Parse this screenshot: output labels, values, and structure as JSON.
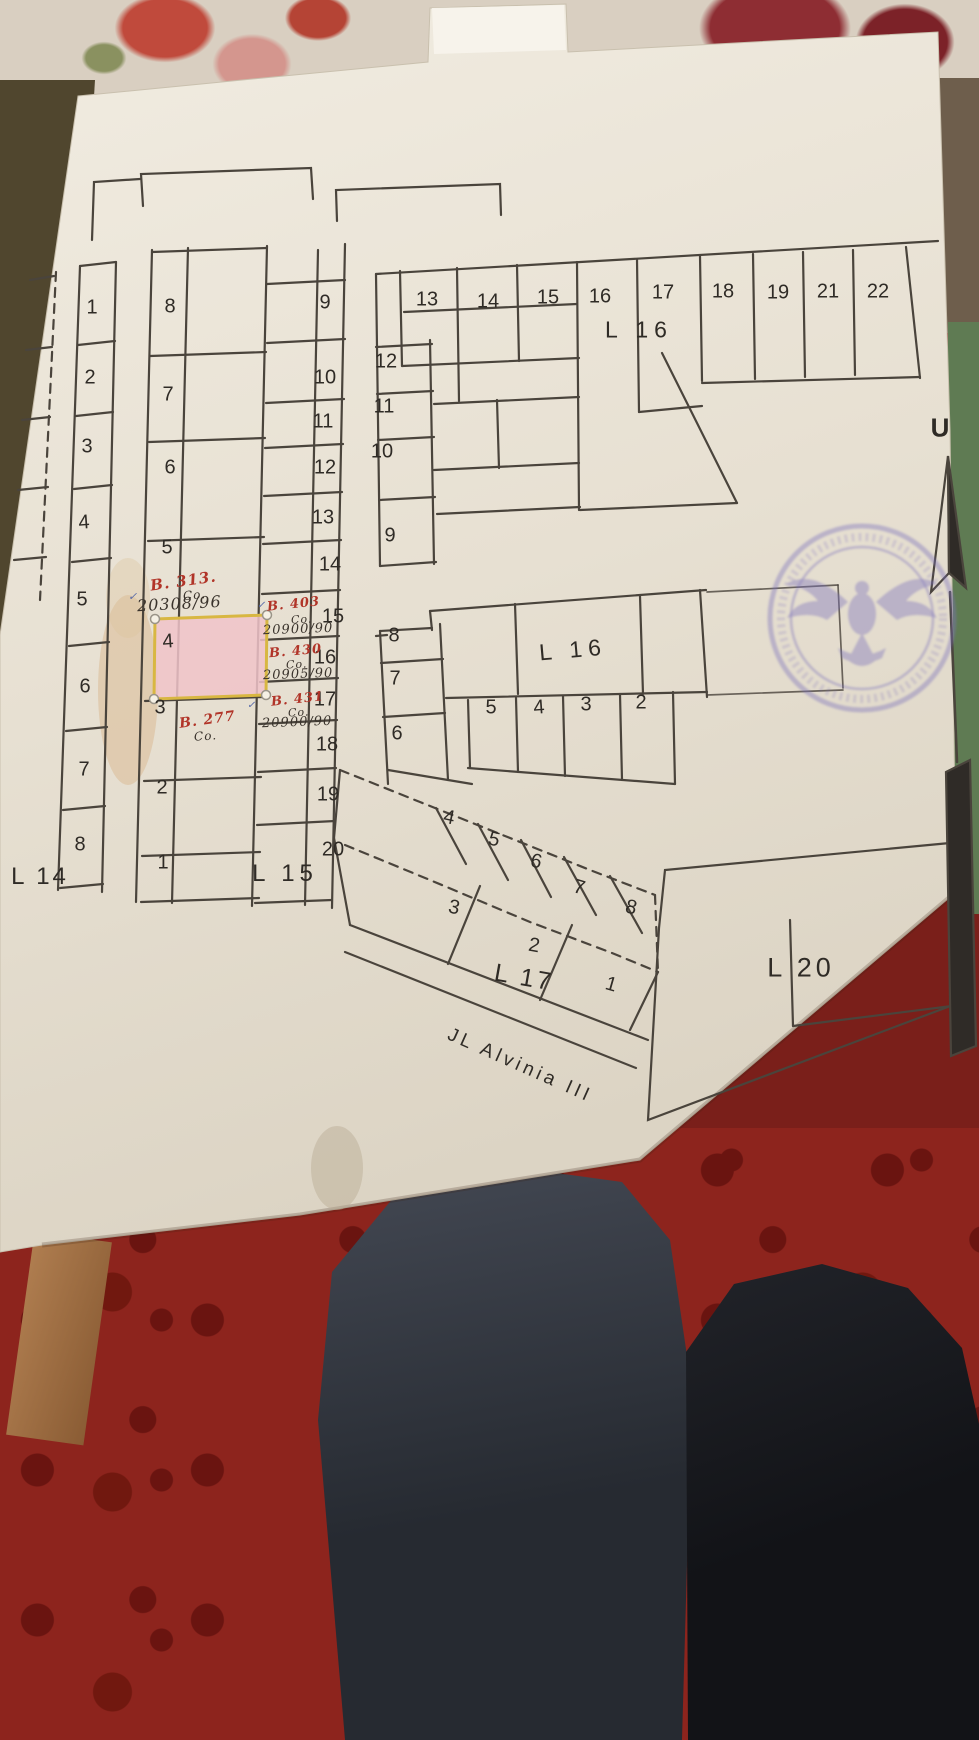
{
  "map": {
    "l14_label": "L 14",
    "l15_label": "L 15",
    "l16_top_label": "L 16",
    "l16_mid_label": "L 16",
    "l17_label": "L 17",
    "l20_label": "L 20",
    "street_label": "JL Alvinia III",
    "compass_label": "U",
    "ink_color": "#2f2b26",
    "red_ink": "#b13428",
    "blue_ink": "#5568a8",
    "highlighted_plot": {
      "block": "L 15",
      "plot": "4",
      "fill": "#f0c3c9",
      "border": "#d8b742"
    },
    "stamp": {
      "shape": "circular",
      "ink": "#7a70bb",
      "emblem": "garuda-eagle",
      "text_legible": false
    },
    "blocks": {
      "l14": {
        "label": "L 14",
        "plots": [
          "1",
          "2",
          "3",
          "4",
          "5",
          "6",
          "7",
          "8"
        ]
      },
      "l15": {
        "label": "L 15",
        "left_plots": [
          "8",
          "7",
          "6",
          "5",
          "4",
          "3",
          "2",
          "1"
        ],
        "right_plots": [
          "9",
          "10",
          "11",
          "12",
          "13",
          "14",
          "15",
          "16",
          "17",
          "18",
          "19",
          "20"
        ]
      },
      "l16_top": {
        "label": "L 16",
        "row_plots": [
          "13",
          "14",
          "15",
          "16",
          "17",
          "18",
          "19",
          "21",
          "22"
        ],
        "col_plots": [
          "12",
          "11",
          "10",
          "9"
        ]
      },
      "l16_mid": {
        "label": "L 16",
        "col_plots": [
          "8",
          "7",
          "6"
        ],
        "row_plots": [
          "5",
          "4",
          "3",
          "2"
        ]
      },
      "l17": {
        "label": "L 17",
        "plots": [
          "4",
          "5",
          "6",
          "7",
          "8",
          "3",
          "2",
          "1"
        ]
      },
      "l20": {
        "label": "L 20"
      }
    },
    "labels": [
      {
        "n": "plot-label-l14-1",
        "t": "1",
        "x": 92,
        "y": 308
      },
      {
        "n": "plot-label-l14-2",
        "t": "2",
        "x": 90,
        "y": 378
      },
      {
        "n": "plot-label-l14-3",
        "t": "3",
        "x": 87,
        "y": 447
      },
      {
        "n": "plot-label-l14-4",
        "t": "4",
        "x": 84,
        "y": 523,
        "r": -4
      },
      {
        "n": "plot-label-l14-5",
        "t": "5",
        "x": 82,
        "y": 600
      },
      {
        "n": "plot-label-l14-6",
        "t": "6",
        "x": 85,
        "y": 687
      },
      {
        "n": "plot-label-l14-7",
        "t": "7",
        "x": 84,
        "y": 770
      },
      {
        "n": "plot-label-l14-8",
        "t": "8",
        "x": 80,
        "y": 845
      },
      {
        "n": "plot-label-l15-8",
        "t": "8",
        "x": 170,
        "y": 307
      },
      {
        "n": "plot-label-l15-7",
        "t": "7",
        "x": 168,
        "y": 395
      },
      {
        "n": "plot-label-l15-6",
        "t": "6",
        "x": 170,
        "y": 468
      },
      {
        "n": "plot-label-l15-5",
        "t": "5",
        "x": 167,
        "y": 548
      },
      {
        "n": "plot-label-l15-4",
        "t": "4",
        "x": 168,
        "y": 642,
        "r": -4
      },
      {
        "n": "plot-label-l15-3",
        "t": "3",
        "x": 160,
        "y": 708
      },
      {
        "n": "plot-label-l15-2",
        "t": "2",
        "x": 162,
        "y": 788
      },
      {
        "n": "plot-label-l15-1",
        "t": "1",
        "x": 163,
        "y": 863
      },
      {
        "n": "plot-label-l15-9",
        "t": "9",
        "x": 325,
        "y": 303
      },
      {
        "n": "plot-label-l15-10",
        "t": "10",
        "x": 325,
        "y": 378
      },
      {
        "n": "plot-label-l15-11",
        "t": "11",
        "x": 323,
        "y": 422
      },
      {
        "n": "plot-label-l15-12",
        "t": "12",
        "x": 325,
        "y": 468
      },
      {
        "n": "plot-label-l15-13",
        "t": "13",
        "x": 323,
        "y": 518
      },
      {
        "n": "plot-label-l15-14",
        "t": "14",
        "x": 330,
        "y": 565
      },
      {
        "n": "plot-label-l15-15",
        "t": "15",
        "x": 333,
        "y": 617
      },
      {
        "n": "plot-label-l15-16",
        "t": "16",
        "x": 325,
        "y": 658
      },
      {
        "n": "plot-label-l15-17",
        "t": "17",
        "x": 325,
        "y": 700
      },
      {
        "n": "plot-label-l15-18",
        "t": "18",
        "x": 327,
        "y": 745
      },
      {
        "n": "plot-label-l15-19",
        "t": "19",
        "x": 328,
        "y": 795
      },
      {
        "n": "plot-label-l15-20",
        "t": "20",
        "x": 333,
        "y": 850
      },
      {
        "n": "plot-label-l16-13",
        "t": "13",
        "x": 427,
        "y": 300
      },
      {
        "n": "plot-label-l16-14",
        "t": "14",
        "x": 488,
        "y": 302
      },
      {
        "n": "plot-label-l16-15",
        "t": "15",
        "x": 548,
        "y": 298
      },
      {
        "n": "plot-label-l16-16",
        "t": "16",
        "x": 600,
        "y": 297
      },
      {
        "n": "plot-label-l16-17",
        "t": "17",
        "x": 663,
        "y": 293
      },
      {
        "n": "plot-label-l16-18",
        "t": "18",
        "x": 723,
        "y": 292
      },
      {
        "n": "plot-label-l16-19",
        "t": "19",
        "x": 778,
        "y": 293
      },
      {
        "n": "plot-label-l16-21",
        "t": "21",
        "x": 828,
        "y": 292
      },
      {
        "n": "plot-label-l16-22",
        "t": "22",
        "x": 878,
        "y": 292
      },
      {
        "n": "plot-label-l16-12",
        "t": "12",
        "x": 386,
        "y": 362
      },
      {
        "n": "plot-label-l16-11",
        "t": "11",
        "x": 384,
        "y": 407
      },
      {
        "n": "plot-label-l16-10",
        "t": "10",
        "x": 382,
        "y": 452
      },
      {
        "n": "plot-label-l16-9",
        "t": "9",
        "x": 390,
        "y": 536
      },
      {
        "n": "plot-label-l16b-8",
        "t": "8",
        "x": 394,
        "y": 636
      },
      {
        "n": "plot-label-l16b-7",
        "t": "7",
        "x": 395,
        "y": 679
      },
      {
        "n": "plot-label-l16b-6",
        "t": "6",
        "x": 397,
        "y": 734
      },
      {
        "n": "plot-label-l16b-5",
        "t": "5",
        "x": 491,
        "y": 708
      },
      {
        "n": "plot-label-l16b-4",
        "t": "4",
        "x": 539,
        "y": 708,
        "r": -4
      },
      {
        "n": "plot-label-l16b-3",
        "t": "3",
        "x": 586,
        "y": 705
      },
      {
        "n": "plot-label-l16b-2",
        "t": "2",
        "x": 641,
        "y": 703
      },
      {
        "n": "plot-label-l17-4",
        "t": "4",
        "x": 449,
        "y": 818,
        "r": 12
      },
      {
        "n": "plot-label-l17-5",
        "t": "5",
        "x": 494,
        "y": 840,
        "r": 14
      },
      {
        "n": "plot-label-l17-6",
        "t": "6",
        "x": 536,
        "y": 862,
        "r": 14
      },
      {
        "n": "plot-label-l17-7",
        "t": "7",
        "x": 579,
        "y": 888,
        "r": 16
      },
      {
        "n": "plot-label-l17-8",
        "t": "8",
        "x": 631,
        "y": 908,
        "r": 14
      },
      {
        "n": "plot-label-l17-3",
        "t": "3",
        "x": 454,
        "y": 908,
        "r": 12
      },
      {
        "n": "plot-label-l17-2",
        "t": "2",
        "x": 534,
        "y": 946,
        "r": 10
      },
      {
        "n": "plot-label-l17-1",
        "t": "1",
        "x": 611,
        "y": 985,
        "r": 16
      }
    ],
    "annotations": [
      {
        "n": "handwriting-b313",
        "t": "B. 313.",
        "x": 150,
        "y": 572,
        "s": 15,
        "r": -8,
        "c": "#b13428",
        "w": 700
      },
      {
        "n": "handwriting-co-1",
        "t": "Co.",
        "x": 183,
        "y": 588,
        "s": 12,
        "r": -5
      },
      {
        "n": "handwriting-20308",
        "t": "20308/96",
        "x": 137,
        "y": 594,
        "s": 16,
        "r": -3
      },
      {
        "n": "handwriting-check-1",
        "t": "✓",
        "x": 128,
        "y": 590,
        "s": 11,
        "c": "#5568a8"
      },
      {
        "n": "handwriting-b403",
        "t": "B. 403",
        "x": 267,
        "y": 597,
        "s": 13,
        "r": -6,
        "c": "#b13428",
        "w": 700
      },
      {
        "n": "handwriting-co-2",
        "t": "Co.",
        "x": 291,
        "y": 613,
        "s": 11,
        "r": -3
      },
      {
        "n": "handwriting-20900a",
        "t": "20900/90",
        "x": 263,
        "y": 622,
        "s": 13,
        "r": -2
      },
      {
        "n": "handwriting-check-2",
        "t": "✓",
        "x": 257,
        "y": 600,
        "s": 10,
        "c": "#5568a8"
      },
      {
        "n": "handwriting-b430",
        "t": "B. 430",
        "x": 269,
        "y": 644,
        "s": 13,
        "r": -5,
        "c": "#b13428",
        "w": 700
      },
      {
        "n": "handwriting-co-3",
        "t": "Co.",
        "x": 286,
        "y": 658,
        "s": 11,
        "r": -3
      },
      {
        "n": "handwriting-20905",
        "t": "20905/90",
        "x": 263,
        "y": 667,
        "s": 13,
        "r": -2
      },
      {
        "n": "handwriting-b431",
        "t": "B. 431",
        "x": 271,
        "y": 692,
        "s": 13,
        "r": -6,
        "c": "#b13428",
        "w": 700
      },
      {
        "n": "handwriting-co-4",
        "t": "Co.",
        "x": 288,
        "y": 706,
        "s": 11,
        "r": -3
      },
      {
        "n": "handwriting-20900b",
        "t": "20900/90",
        "x": 262,
        "y": 715,
        "s": 13,
        "r": -2
      },
      {
        "n": "handwriting-b277",
        "t": "B. 277",
        "x": 179,
        "y": 712,
        "s": 14,
        "r": -8,
        "c": "#b13428",
        "w": 700
      },
      {
        "n": "handwriting-co-5",
        "t": "Co.",
        "x": 194,
        "y": 729,
        "s": 12,
        "r": -4
      },
      {
        "n": "handwriting-check-3",
        "t": "✓",
        "x": 247,
        "y": 700,
        "s": 10,
        "c": "#5568a8"
      }
    ]
  }
}
